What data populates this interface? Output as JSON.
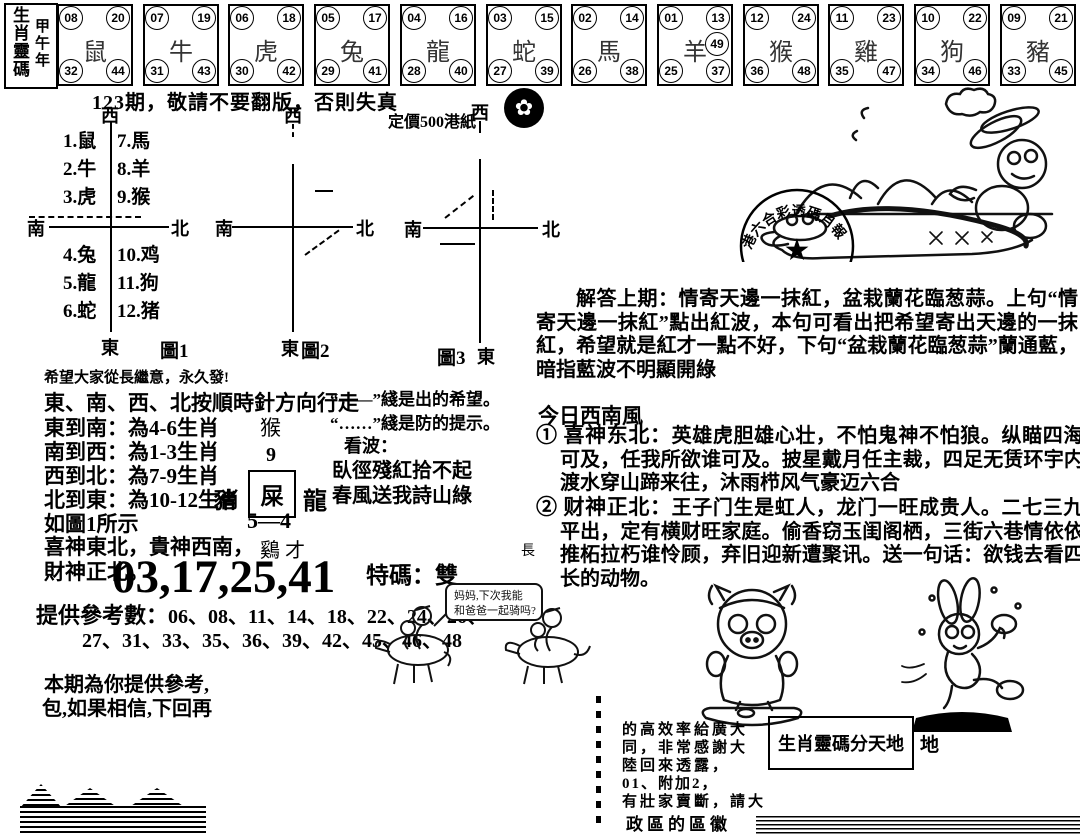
{
  "masthead": {
    "title": "生肖靈碼",
    "year": "甲午年"
  },
  "page": {
    "issue_notice": "123期，敬請不要翻版，否則失真",
    "price": "定價500港紙",
    "stamp_arc": "港六合彩透碼月報",
    "stamp_star": "★"
  },
  "zodiac_row": {
    "boxes": [
      {
        "tl": "08",
        "tr": "20",
        "bl": "32",
        "br": "44",
        "animal": "鼠",
        "extra": ""
      },
      {
        "tl": "07",
        "tr": "19",
        "bl": "31",
        "br": "43",
        "animal": "牛",
        "extra": ""
      },
      {
        "tl": "06",
        "tr": "18",
        "bl": "30",
        "br": "42",
        "animal": "虎",
        "extra": ""
      },
      {
        "tl": "05",
        "tr": "17",
        "bl": "29",
        "br": "41",
        "animal": "兔",
        "extra": ""
      },
      {
        "tl": "04",
        "tr": "16",
        "bl": "28",
        "br": "40",
        "animal": "龍",
        "extra": ""
      },
      {
        "tl": "03",
        "tr": "15",
        "bl": "27",
        "br": "39",
        "animal": "蛇",
        "extra": ""
      },
      {
        "tl": "02",
        "tr": "14",
        "bl": "26",
        "br": "38",
        "animal": "馬",
        "extra": ""
      },
      {
        "tl": "01",
        "tr": "13",
        "bl": "25",
        "br": "37",
        "animal": "羊",
        "extra": "49"
      },
      {
        "tl": "12",
        "tr": "24",
        "bl": "36",
        "br": "48",
        "animal": "猴",
        "extra": ""
      },
      {
        "tl": "11",
        "tr": "23",
        "bl": "35",
        "br": "47",
        "animal": "雞",
        "extra": ""
      },
      {
        "tl": "10",
        "tr": "22",
        "bl": "34",
        "br": "46",
        "animal": "狗",
        "extra": ""
      },
      {
        "tl": "09",
        "tr": "21",
        "bl": "33",
        "br": "45",
        "animal": "豬",
        "extra": ""
      }
    ]
  },
  "zodiac_legend": {
    "top_left": [
      "1.鼠",
      "2.牛",
      "3.虎"
    ],
    "top_right": [
      "7.馬",
      "8.羊",
      "9.猴"
    ],
    "bottom_left": [
      "4.兔",
      "5.龍",
      "6.蛇"
    ],
    "bottom_right": [
      "10.鸡",
      "11.狗",
      "12.猪"
    ]
  },
  "compass": {
    "west": "西",
    "south": "南",
    "north": "北",
    "east": "東",
    "d1": "圖1",
    "d2": "圖2",
    "d3": "圖3"
  },
  "left_col": {
    "hope_line": "希望大家從長繼意，永久發!",
    "direction_lines": [
      "東、南、西、北按順時針方向行走",
      "東到南：為4-6生肖",
      "南到西：為1-3生肖",
      "西到北：為7-9生肖",
      "北到東：為10-12生肖",
      "如圖1所示",
      "喜神東北，貴神西南，",
      "財神正北。"
    ],
    "legend_solid": "“——”綫是出的希望。",
    "legend_dotted": "“……”綫是防的提示。",
    "kanbo_title": "看波：",
    "kanbo_line1": "臥徑殘紅拾不起",
    "kanbo_line2": "春風送我詩山綠",
    "mini": {
      "monkey": "猴",
      "nine": "9",
      "boxed": "屎",
      "left": "豬",
      "right": "龍",
      "below": "5—4",
      "bottom": "鷄 才"
    },
    "main_numbers": "03,17,25,41",
    "special": "特碼：雙",
    "ref_label": "提供參考數：",
    "ref_line1": "06、08、11、14、18、22、24、26、",
    "ref_line2": "27、31、33、35、36、39、42、45、46、48",
    "partial1": "本期為你提供參考,",
    "partial2": "包,如果相信,下回再"
  },
  "right_col": {
    "answer": "解答上期：情寄天邊一抹紅，盆栽蘭花臨葱蒜。上句“情寄天邊一抹紅”點出紅波，本句可看出把希望寄出天邊的一抹紅，希望就是紅才一點不好，下句“盆栽蘭花臨葱蒜”蘭通藍，暗指藍波不明顯開綠",
    "today": "今日西南風",
    "item1_lead": "① 喜神东北：",
    "item1_body": "英雄虎胆雄心壮，不怕鬼神不怕狼。纵瞄四海谁可及，任我所欲谁可及。披星戴月任主裁，四足无赁环宇内，渡水穿山蹄来往，沐雨栉风气豪迈六合",
    "item2_lead": "② 财神正北：",
    "item2_body": "王子门生是虹人，龙门一旺成贵人。二七三九平平出，定有横财旺家庭。偷香窃玉闺阁栖，三街六巷情依依，推柘拉朽谁怜顾，弃旧迎新遭聚讯。送一句话：欲钱去看四脚长的动物。",
    "stray_char": "長"
  },
  "horse_cartoon": {
    "bubble1": "妈妈,下次我能",
    "bubble2": "和爸爸一起骑吗?"
  },
  "bottom_right": {
    "partials": [
      "的高效率給廣大",
      "同，非常感謝大",
      "陸回來透露，",
      "01、附加2，",
      "有壯家賣斷，請大"
    ],
    "box_text": "生肖靈碼分天地",
    "outside_char": "地",
    "last_line": "政區的區徽"
  },
  "colors": {
    "ink": "#000000",
    "paper": "#ffffff"
  }
}
